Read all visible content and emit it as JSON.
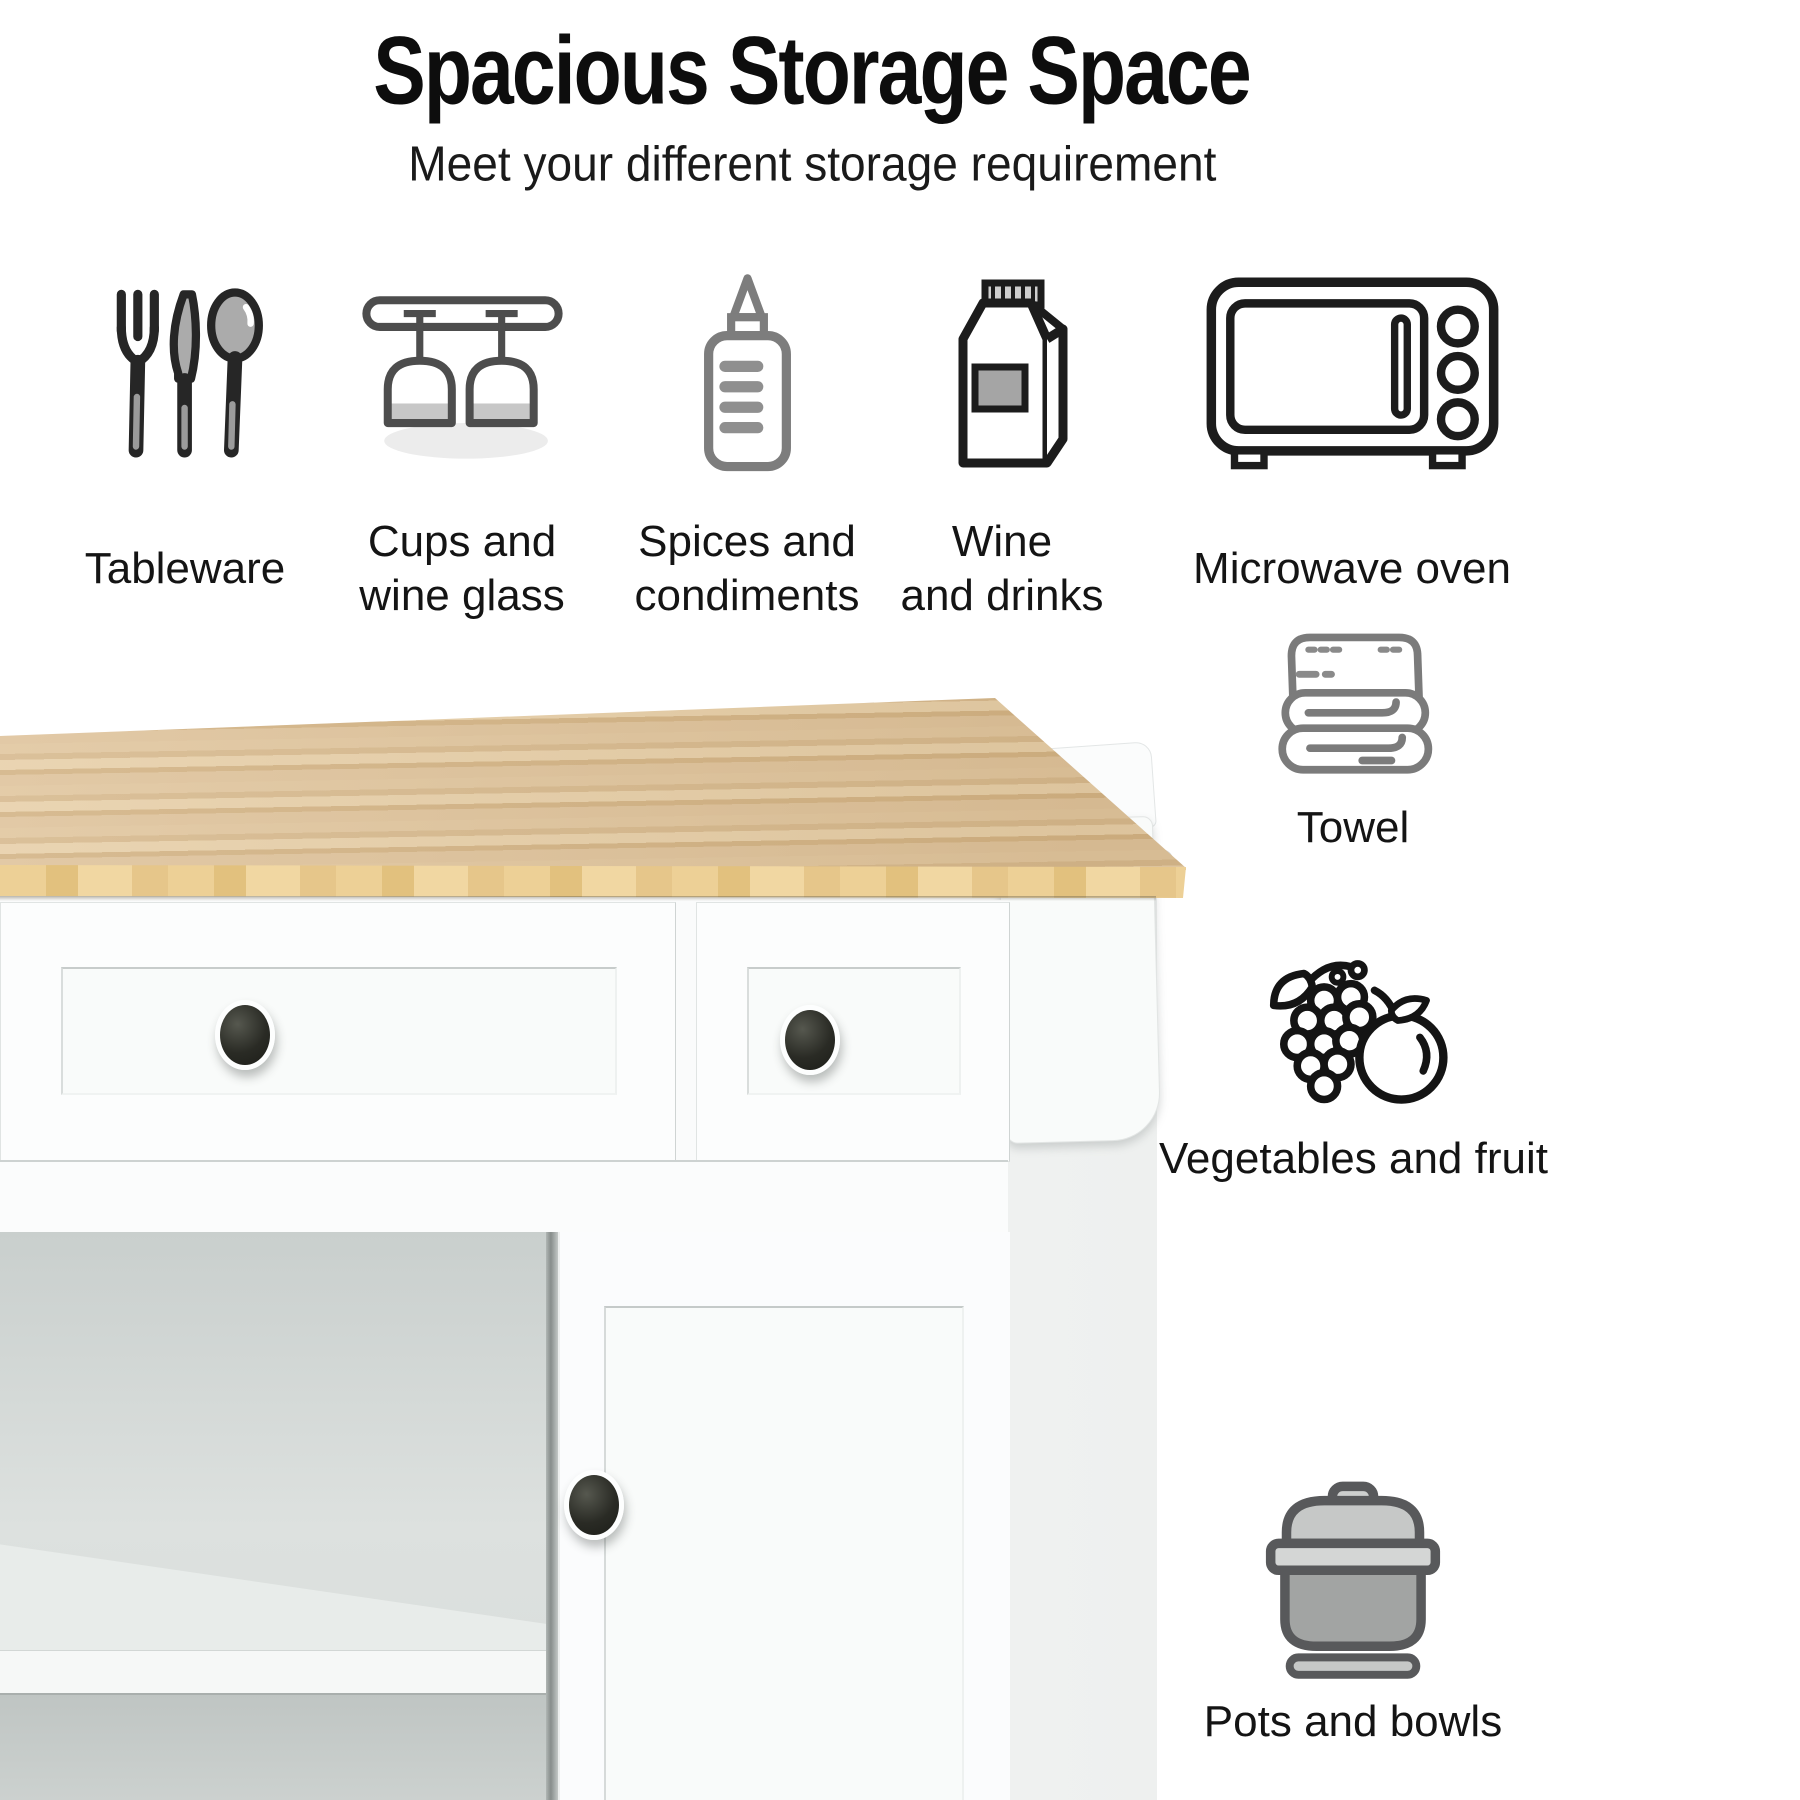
{
  "title": "Spacious Storage Space",
  "subtitle": "Meet your different storage requirement",
  "features_top": [
    {
      "icon": "tableware-icon",
      "line1": "Tableware"
    },
    {
      "icon": "wine-glass-rack-icon",
      "line1": "Cups and",
      "line2": "wine glass"
    },
    {
      "icon": "squeeze-bottle-icon",
      "line1": "Spices and",
      "line2": "condiments"
    },
    {
      "icon": "drink-carton-icon",
      "line1": "Wine",
      "line2": "and drinks"
    },
    {
      "icon": "microwave-oven-icon",
      "line1": "Microwave oven"
    }
  ],
  "features_side": [
    {
      "icon": "towel-icon",
      "label": "Towel"
    },
    {
      "icon": "vegetables-and-fruit-icon",
      "label": "Vegetables and fruit"
    },
    {
      "icon": "pot-icon",
      "label": "Pots and bowls"
    }
  ],
  "photo_alt": "White kitchen cart with natural rubber wood top, two drawers with black knobs, open shelves, one cabinet door, and a side towel bar with spice rack",
  "colors": {
    "background": "#ffffff",
    "text": "#141414",
    "wood_top": "#dcc096",
    "wood_edge": "#e9ca8d",
    "cart_white": "#fbfcfc",
    "interior_gray": "#c9cfcd",
    "knob_black": "#26271f",
    "icon_gray": "#7d7d7d",
    "icon_dark": "#1d1d1d"
  }
}
